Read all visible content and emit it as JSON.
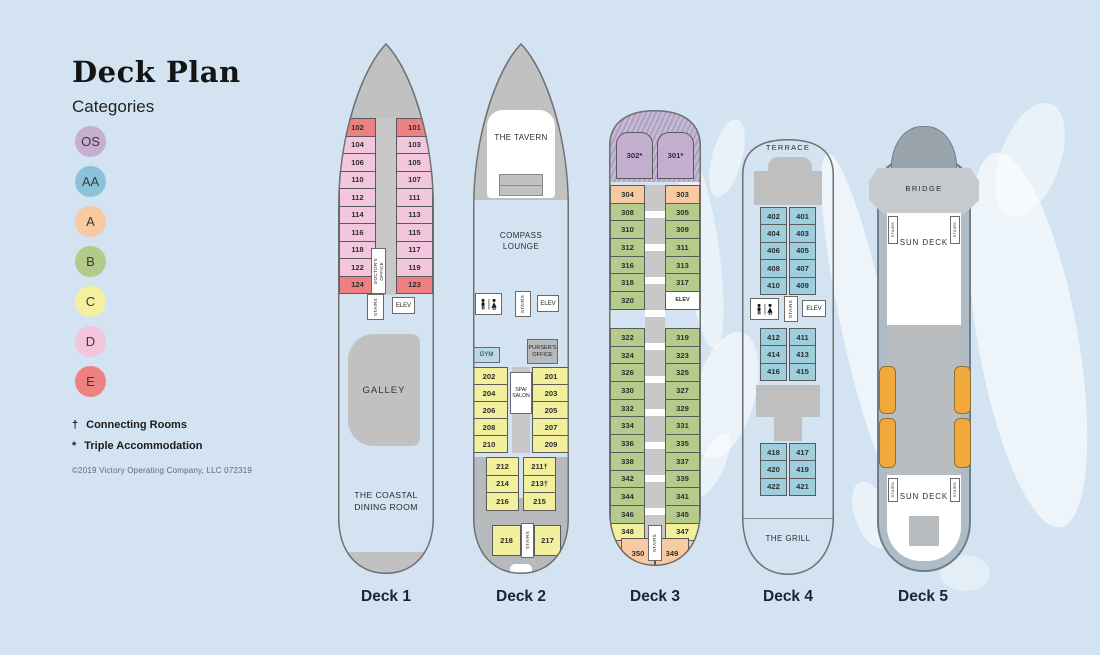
{
  "legend": {
    "title": "Deck Plan",
    "subtitle": "Categories",
    "categories": [
      {
        "code": "OS",
        "color": "#c5aed0"
      },
      {
        "code": "AA",
        "color": "#8cc2d7"
      },
      {
        "code": "A",
        "color": "#f9c9a2"
      },
      {
        "code": "B",
        "color": "#b2cb88"
      },
      {
        "code": "C",
        "color": "#f3f09e"
      },
      {
        "code": "D",
        "color": "#f2c5dc"
      },
      {
        "code": "E",
        "color": "#ee8181"
      }
    ],
    "notes": [
      {
        "symbol": "†",
        "label": "Connecting Rooms"
      },
      {
        "symbol": "*",
        "label": "Triple Accommodation"
      }
    ],
    "copyright": "©2019 Victory Operating Company, LLC   072319"
  },
  "category_colors": {
    "OS": "#c3aed0",
    "AA": "#9fcfdc",
    "A": "#f8caa1",
    "B": "#b4cb8b",
    "C": "#f2ef9d",
    "D": "#f2c6dd",
    "E": "#ed8181",
    "SVC": "#ffffff"
  },
  "decks": [
    {
      "label": "Deck 1",
      "rows": [
        {
          "l": "102",
          "lc": "E",
          "r": "101",
          "rc": "E"
        },
        {
          "l": "104",
          "lc": "D",
          "r": "103",
          "rc": "D"
        },
        {
          "l": "106",
          "lc": "D",
          "r": "105",
          "rc": "D"
        },
        {
          "l": "110",
          "lc": "D",
          "r": "107",
          "rc": "D"
        },
        {
          "l": "112",
          "lc": "D",
          "r": "111",
          "rc": "D"
        },
        {
          "l": "114",
          "lc": "D",
          "r": "113",
          "rc": "D"
        },
        {
          "l": "116",
          "lc": "D",
          "r": "115",
          "rc": "D"
        },
        {
          "l": "118",
          "lc": "D",
          "r": "117",
          "rc": "D"
        },
        {
          "l": "122",
          "lc": "D",
          "r": "119",
          "rc": "D"
        },
        {
          "l": "124",
          "lc": "E",
          "r": "123",
          "rc": "E"
        }
      ],
      "texts": {
        "doctors1": "DOCTOR'S",
        "doctors2": "OFFICE",
        "stairs": "STAIRS",
        "elev": "ELEV",
        "galley": "GALLEY",
        "dining": "THE COASTAL DINING ROOM"
      }
    },
    {
      "label": "Deck 2",
      "rows_a": [
        {
          "l": "202",
          "lc": "C",
          "r": "201",
          "rc": "C"
        },
        {
          "l": "204",
          "lc": "C",
          "r": "203",
          "rc": "C"
        },
        {
          "l": "206",
          "lc": "C",
          "r": "205",
          "rc": "C"
        },
        {
          "l": "208",
          "lc": "C",
          "r": "207",
          "rc": "C"
        },
        {
          "l": "210",
          "lc": "C",
          "r": "209",
          "rc": "C"
        }
      ],
      "rows_b": [
        {
          "l": "212",
          "lc": "C",
          "r": "211†",
          "rc": "C"
        },
        {
          "l": "214",
          "lc": "C",
          "r": "213†",
          "rc": "C"
        },
        {
          "l": "216",
          "lc": "C",
          "r": "215",
          "rc": "C"
        }
      ],
      "stern": {
        "l": "218",
        "stairs": "STAIRS",
        "r": "217"
      },
      "texts": {
        "tavern": "THE TAVERN",
        "lounge": "COMPASS LOUNGE",
        "gym": "GYM",
        "pursers": "PURSER'S OFFICE",
        "spa": "SPA/ SALON",
        "stairs": "STAIRS",
        "elev": "ELEV"
      }
    },
    {
      "label": "Deck 3",
      "suites": [
        "302*",
        "301*"
      ],
      "rows_fwd": [
        {
          "l": "304",
          "lc": "A",
          "r": "303",
          "rc": "A"
        },
        {
          "l": "308",
          "lc": "B",
          "r": "305",
          "rc": "B"
        },
        {
          "l": "310",
          "lc": "B",
          "r": "309",
          "rc": "B"
        },
        {
          "l": "312",
          "lc": "B",
          "r": "311",
          "rc": "B"
        },
        {
          "l": "316",
          "lc": "B",
          "r": "313",
          "rc": "B"
        },
        {
          "l": "318",
          "lc": "B",
          "r": "317",
          "rc": "B"
        },
        {
          "l": "320",
          "lc": "B",
          "r": "ELEV",
          "rc": "SVC"
        }
      ],
      "rows_aft": [
        {
          "l": "322",
          "lc": "B",
          "r": "319",
          "rc": "B"
        },
        {
          "l": "324",
          "lc": "B",
          "r": "323",
          "rc": "B"
        },
        {
          "l": "326",
          "lc": "B",
          "r": "325",
          "rc": "B"
        },
        {
          "l": "330",
          "lc": "B",
          "r": "327",
          "rc": "B"
        },
        {
          "l": "332",
          "lc": "B",
          "r": "329",
          "rc": "B"
        },
        {
          "l": "334",
          "lc": "B",
          "r": "331",
          "rc": "B"
        },
        {
          "l": "336",
          "lc": "B",
          "r": "335",
          "rc": "B"
        },
        {
          "l": "338",
          "lc": "B",
          "r": "337",
          "rc": "B"
        },
        {
          "l": "342",
          "lc": "B",
          "r": "339",
          "rc": "B"
        },
        {
          "l": "344",
          "lc": "B",
          "r": "341",
          "rc": "B"
        },
        {
          "l": "346",
          "lc": "B",
          "r": "345",
          "rc": "B"
        },
        {
          "l": "348",
          "lc": "C",
          "r": "347",
          "rc": "C"
        }
      ],
      "stern": {
        "l": "350",
        "r": "349"
      },
      "texts": {
        "stairs": "STAIRS"
      }
    },
    {
      "label": "Deck 4",
      "rows_a": [
        {
          "l": "402",
          "lc": "AA",
          "r": "401",
          "rc": "AA"
        },
        {
          "l": "404",
          "lc": "AA",
          "r": "403",
          "rc": "AA"
        },
        {
          "l": "406",
          "lc": "AA",
          "r": "405",
          "rc": "AA"
        },
        {
          "l": "408",
          "lc": "AA",
          "r": "407",
          "rc": "AA"
        },
        {
          "l": "410",
          "lc": "AA",
          "r": "409",
          "rc": "AA"
        }
      ],
      "rows_b": [
        {
          "l": "412",
          "lc": "AA",
          "r": "411",
          "rc": "AA"
        },
        {
          "l": "414",
          "lc": "AA",
          "r": "413",
          "rc": "AA"
        },
        {
          "l": "416",
          "lc": "AA",
          "r": "415",
          "rc": "AA"
        }
      ],
      "rows_c": [
        {
          "l": "418",
          "lc": "AA",
          "r": "417",
          "rc": "AA"
        },
        {
          "l": "420",
          "lc": "AA",
          "r": "419",
          "rc": "AA"
        },
        {
          "l": "422",
          "lc": "AA",
          "r": "421",
          "rc": "AA"
        }
      ],
      "texts": {
        "terrace": "TERRACE",
        "grill": "THE GRILL",
        "stairs": "STAIRS",
        "elev": "ELEV"
      }
    },
    {
      "label": "Deck 5",
      "texts": {
        "bridge": "BRIDGE",
        "sundeck_fwd": "SUN DECK",
        "sundeck_aft": "SUN DECK",
        "stairs": "STAIRS"
      }
    }
  ]
}
